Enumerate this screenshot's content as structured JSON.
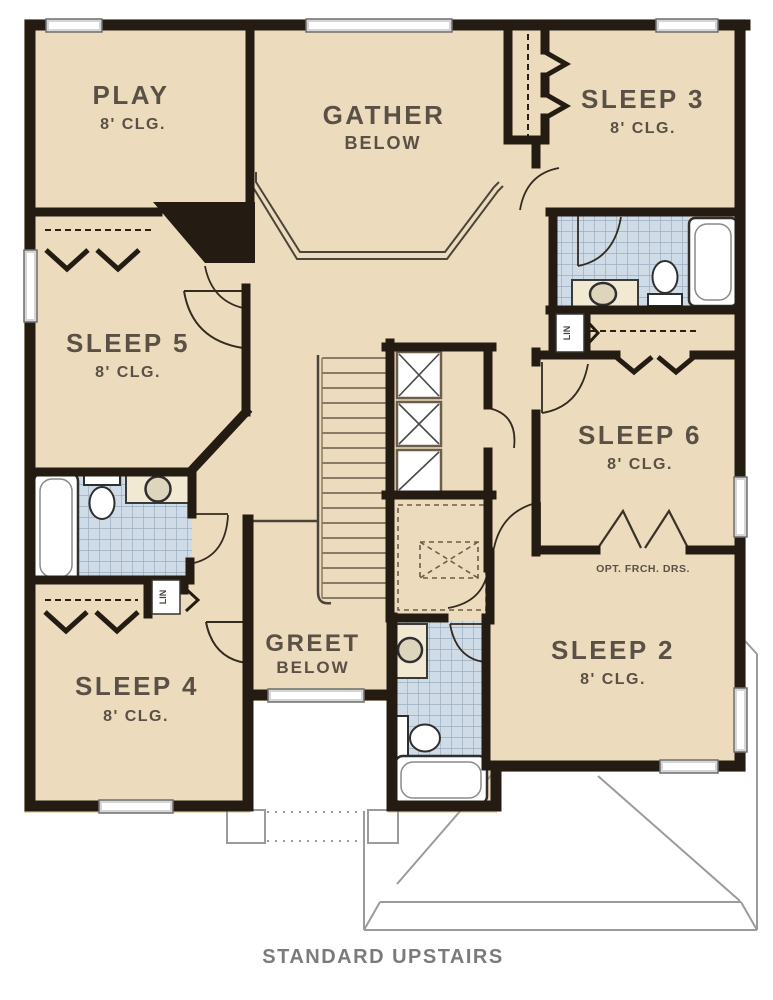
{
  "plan": {
    "type": "floor-plan",
    "caption": "STANDARD UPSTAIRS",
    "rooms": [
      {
        "name": "PLAY",
        "detail": "8' CLG."
      },
      {
        "name": "GATHER",
        "detail": "BELOW"
      },
      {
        "name": "SLEEP 3",
        "detail": "8' CLG."
      },
      {
        "name": "SLEEP 5",
        "detail": "8' CLG."
      },
      {
        "name": "SLEEP 6",
        "detail": "8' CLG."
      },
      {
        "name": "SLEEP 4",
        "detail": "8' CLG."
      },
      {
        "name": "GREET",
        "detail": "BELOW"
      },
      {
        "name": "SLEEP 2",
        "detail": "8' CLG."
      }
    ],
    "annotations": {
      "optional_doors": "OPT. FRCH. DRS.",
      "linen_closet_1": "LIN",
      "linen_closet_2": "LIN"
    },
    "colors": {
      "floor": "#ecdcbd",
      "wall": "#241c12",
      "tile": "#cfdbe6",
      "tile_line": "#92a7ba",
      "window_frame": "#6e6e6e",
      "label_text": "#5a5046",
      "caption_text": "#7b7b7b",
      "roof_line": "#9b9b9b"
    }
  }
}
